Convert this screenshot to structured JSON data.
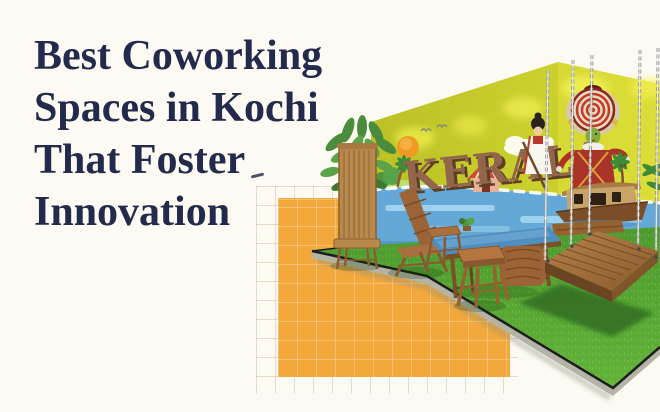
{
  "page": {
    "background_color": "#fcfaf2"
  },
  "title": {
    "text": "Best Coworking Spaces in Kochi That Foster Innovation",
    "lines": [
      "Best Coworking",
      "Spaces in Kochi",
      "That Foster",
      "Innovation"
    ],
    "color": "#232b4d"
  },
  "decor": {
    "orange_square_color": "#f3a83c",
    "grid_line_color": "#d8c9a8"
  },
  "photo": {
    "description": "Coworking lounge corner with a Kerala-themed mural wall, artificial grass floor, wooden chairs, stools, a glass-top table and a hanging wooden swing bench",
    "mural": {
      "text": "KERALA",
      "wall_color": "#ccd32e",
      "letter_color": "#92664a",
      "water_color": "#64a8d8"
    },
    "grass_color": "#57a733",
    "wood_color": "#9c6b3a"
  }
}
